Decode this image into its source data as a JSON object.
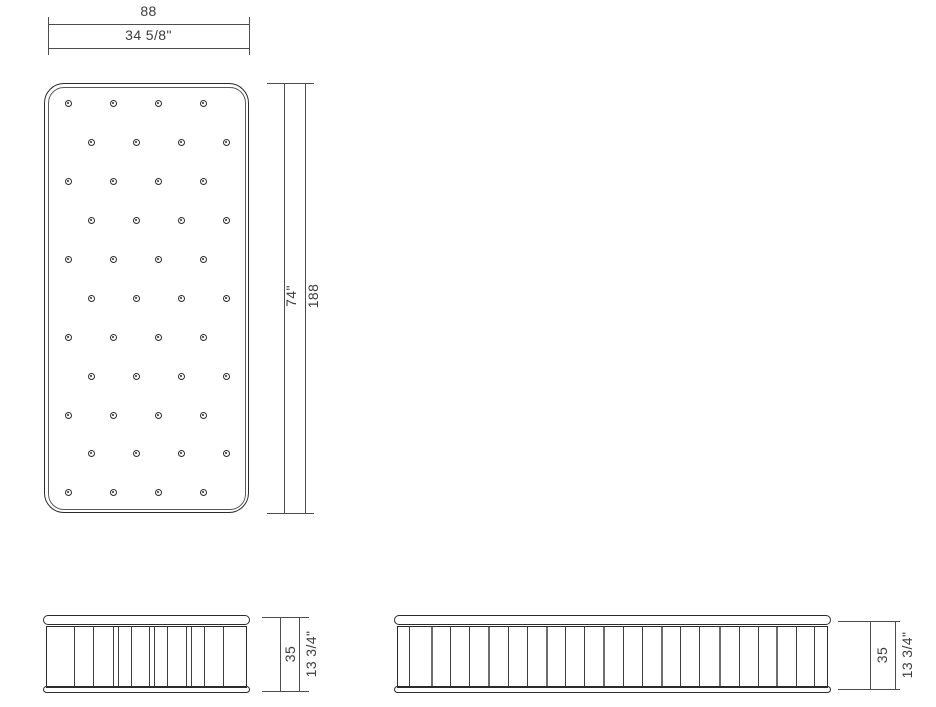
{
  "figure": {
    "type": "technical-drawing",
    "subject": "mattress",
    "views": [
      "top-plan",
      "front-side",
      "long-side"
    ]
  },
  "colors": {
    "background": "#ffffff",
    "outline": "#2b2b2b",
    "seam_line": "#5a5a5a",
    "quilt_line": "#3f3f3f",
    "dimension_line": "#4d4d4d",
    "text": "#3d3d3d"
  },
  "dimensions": {
    "width": {
      "cm": "88",
      "in": "34 5/8\""
    },
    "length": {
      "in": "74\"",
      "cm": "188"
    },
    "height_front": {
      "cm": "35",
      "in": "13 3/4\""
    },
    "height_long": {
      "cm": "35",
      "in": "13 3/4\""
    }
  },
  "top_view": {
    "tuft_button_rows": [
      {
        "y": 103,
        "xs": [
          68,
          113,
          158,
          203
        ]
      },
      {
        "y": 142,
        "xs": [
          91,
          136,
          181,
          226
        ]
      },
      {
        "y": 181,
        "xs": [
          68,
          113,
          158,
          203
        ]
      },
      {
        "y": 220,
        "xs": [
          91,
          136,
          181,
          226
        ]
      },
      {
        "y": 259,
        "xs": [
          68,
          113,
          158,
          203
        ]
      },
      {
        "y": 298,
        "xs": [
          91,
          136,
          181,
          226
        ]
      },
      {
        "y": 337,
        "xs": [
          68,
          113,
          158,
          203
        ]
      },
      {
        "y": 376,
        "xs": [
          91,
          136,
          181,
          226
        ]
      },
      {
        "y": 415,
        "xs": [
          68,
          113,
          158,
          203
        ]
      },
      {
        "y": 453,
        "xs": [
          91,
          136,
          181,
          226
        ]
      },
      {
        "y": 492,
        "xs": [
          68,
          113,
          158,
          203
        ]
      }
    ]
  },
  "front_view": {
    "quilt_lines": [
      [
        27,
        1
      ],
      [
        46,
        1
      ],
      [
        66,
        1
      ],
      [
        71,
        1
      ],
      [
        84,
        1
      ],
      [
        102,
        1
      ],
      [
        107,
        1
      ],
      [
        120,
        1
      ],
      [
        139,
        1
      ],
      [
        144,
        1
      ],
      [
        157,
        1
      ],
      [
        176,
        1
      ]
    ]
  },
  "long_view": {
    "quilt_lines": [
      [
        11,
        1
      ],
      [
        33,
        2
      ],
      [
        52,
        1
      ],
      [
        71,
        1
      ],
      [
        90,
        2
      ],
      [
        110,
        1
      ],
      [
        129,
        1
      ],
      [
        148,
        2
      ],
      [
        167,
        1
      ],
      [
        186,
        1
      ],
      [
        205,
        2
      ],
      [
        225,
        1
      ],
      [
        244,
        1
      ],
      [
        263,
        2
      ],
      [
        282,
        1
      ],
      [
        301,
        1
      ],
      [
        321,
        2
      ],
      [
        341,
        1
      ],
      [
        360,
        1
      ],
      [
        378,
        2
      ],
      [
        398,
        1
      ],
      [
        416,
        1
      ]
    ]
  }
}
